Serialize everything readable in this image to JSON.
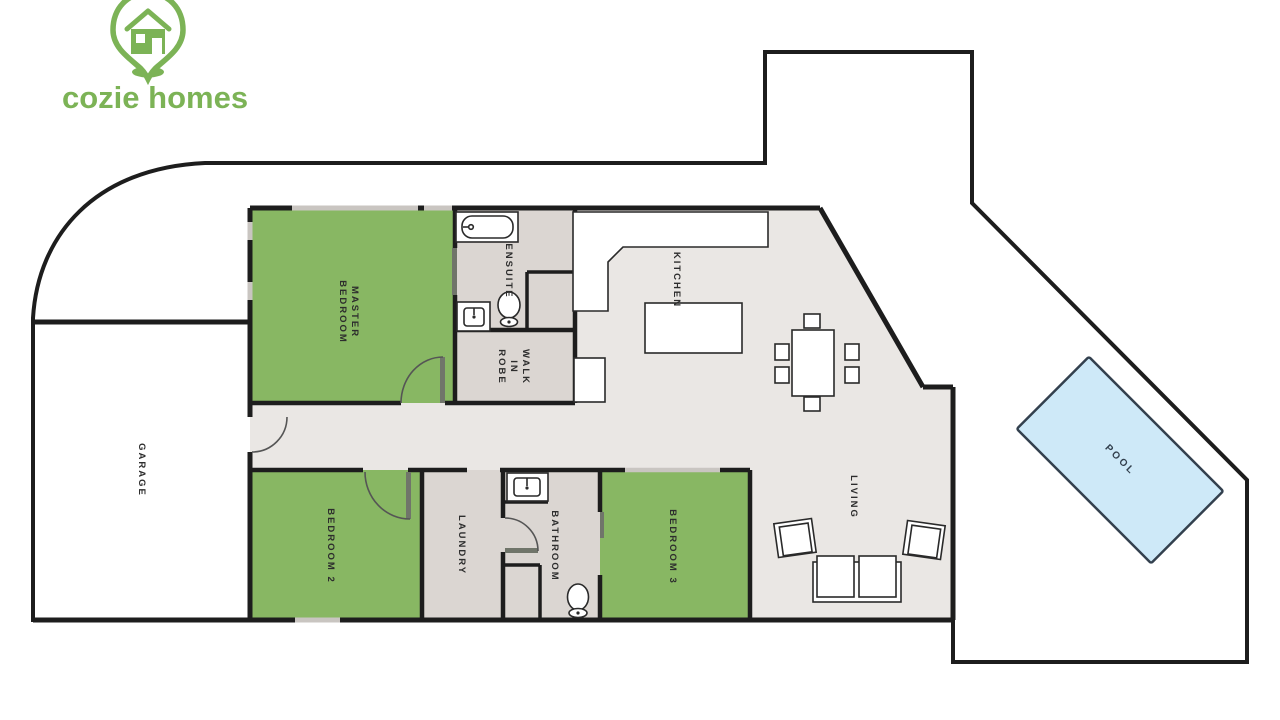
{
  "brand": {
    "name": "cozie homes",
    "icon": "map-pin-house-icon",
    "color": "#7CB356"
  },
  "rooms": {
    "garage": {
      "label": "GARAGE"
    },
    "master_bedroom": {
      "label": "MASTER\nBEDROOM"
    },
    "ensuite": {
      "label": "ENSUITE"
    },
    "walk_in_robe": {
      "label": "WALK\nIN\nROBE"
    },
    "kitchen": {
      "label": "KITCHEN"
    },
    "living": {
      "label": "LIVING"
    },
    "bedroom_2": {
      "label": "BEDROOM 2"
    },
    "bedroom_3": {
      "label": "BEDROOM 3"
    },
    "laundry": {
      "label": "LAUNDRY"
    },
    "bathroom": {
      "label": "BATHROOM"
    },
    "pool": {
      "label": "POOL"
    }
  },
  "fixtures": [
    "bathtub-icon",
    "toilet-icon",
    "vanity-sink-icon",
    "shower-recess",
    "kitchen-bench-icon",
    "kitchen-island-icon",
    "dining-table-icon",
    "dining-chair-icon",
    "sofa-icon",
    "armchair-icon",
    "door-swing-icon",
    "swimming-pool-icon"
  ],
  "colors": {
    "wall": "#1D1D1D",
    "floor_open": "#EAE7E4",
    "floor_wet": "#DBD6D2",
    "room_green": "#88B763",
    "pool_fill": "#CEE9F8",
    "pool_border": "#33404E",
    "brand_green": "#7CB356",
    "label_text": "#2D2D2D",
    "window_line": "#C9C5C1",
    "door_leaf": "#70756A",
    "furniture_line": "#2A2A2A"
  }
}
